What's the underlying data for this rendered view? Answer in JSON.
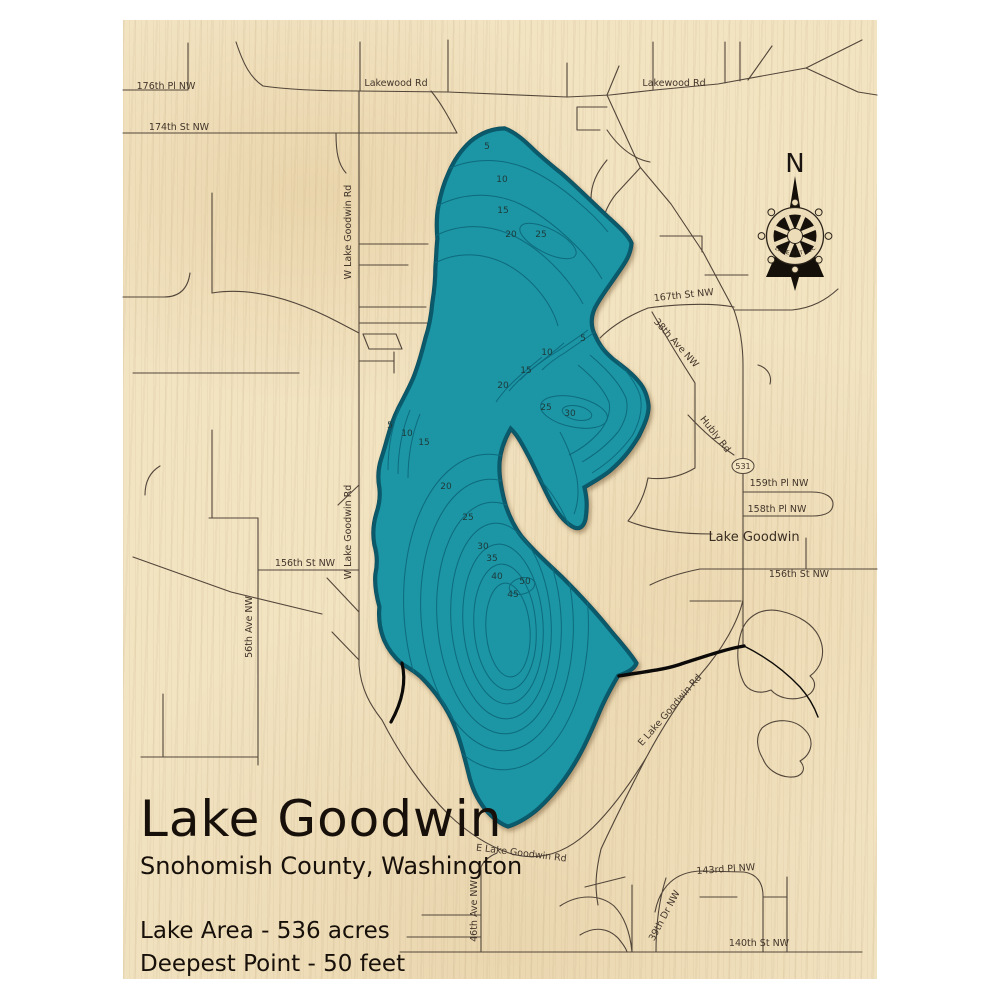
{
  "map": {
    "title": "Lake Goodwin",
    "subtitle": "Snohomish County, Washington",
    "stat_area": "Lake Area - 536 acres",
    "stat_depth": "Deepest Point - 50 feet",
    "route_marker": "531",
    "compass": {
      "north_label": "N",
      "brand": "LAKE ART LLC"
    },
    "colors": {
      "wood": "#f2e3c1",
      "lake_fill": "#1e95a4",
      "lake_edge": "#0a5a6b",
      "contour": "#0d6b7d",
      "road": "#52463a",
      "ink": "#17100a"
    },
    "place_labels": [
      {
        "text": "Lake Goodwin",
        "x": 754,
        "y": 541,
        "rot": 0
      }
    ],
    "road_labels": [
      {
        "text": "176th Pl NW",
        "x": 166,
        "y": 89,
        "rot": 0
      },
      {
        "text": "174th St NW",
        "x": 179,
        "y": 130,
        "rot": 0
      },
      {
        "text": "Lakewood Rd",
        "x": 396,
        "y": 86,
        "rot": 0
      },
      {
        "text": "Lakewood Rd",
        "x": 674,
        "y": 86,
        "rot": 0
      },
      {
        "text": "W Lake Goodwin Rd",
        "x": 351,
        "y": 232,
        "rot": -90
      },
      {
        "text": "W Lake Goodwin Rd",
        "x": 351,
        "y": 532,
        "rot": -90
      },
      {
        "text": "167th St NW",
        "x": 684,
        "y": 298,
        "rot": -6
      },
      {
        "text": "38th Ave NW",
        "x": 674,
        "y": 345,
        "rot": 48
      },
      {
        "text": "Hubly Rd",
        "x": 713,
        "y": 436,
        "rot": 52
      },
      {
        "text": "159th Pl NW",
        "x": 779,
        "y": 486,
        "rot": 0
      },
      {
        "text": "158th Pl NW",
        "x": 777,
        "y": 512,
        "rot": 0
      },
      {
        "text": "156th St NW",
        "x": 799,
        "y": 577,
        "rot": 0
      },
      {
        "text": "156th St NW",
        "x": 305,
        "y": 566,
        "rot": 0
      },
      {
        "text": "56th Ave NW",
        "x": 252,
        "y": 627,
        "rot": -90
      },
      {
        "text": "E Lake Goodwin Rd",
        "x": 672,
        "y": 712,
        "rot": -49
      },
      {
        "text": "E Lake Goodwin Rd",
        "x": 521,
        "y": 856,
        "rot": 7
      },
      {
        "text": "46th Ave NW",
        "x": 477,
        "y": 911,
        "rot": -90
      },
      {
        "text": "39th Dr NW",
        "x": 667,
        "y": 917,
        "rot": -62
      },
      {
        "text": "143rd Pl NW",
        "x": 726,
        "y": 872,
        "rot": -4
      },
      {
        "text": "140th St NW",
        "x": 759,
        "y": 946,
        "rot": 0
      }
    ],
    "depth_labels": [
      {
        "v": "5",
        "x": 487,
        "y": 149
      },
      {
        "v": "10",
        "x": 502,
        "y": 182
      },
      {
        "v": "15",
        "x": 503,
        "y": 213
      },
      {
        "v": "20",
        "x": 511,
        "y": 237
      },
      {
        "v": "25",
        "x": 541,
        "y": 237
      },
      {
        "v": "5",
        "x": 583,
        "y": 341
      },
      {
        "v": "10",
        "x": 547,
        "y": 355
      },
      {
        "v": "15",
        "x": 526,
        "y": 373
      },
      {
        "v": "20",
        "x": 503,
        "y": 388
      },
      {
        "v": "25",
        "x": 546,
        "y": 410
      },
      {
        "v": "30",
        "x": 570,
        "y": 416
      },
      {
        "v": "5",
        "x": 390,
        "y": 428
      },
      {
        "v": "10",
        "x": 407,
        "y": 436
      },
      {
        "v": "15",
        "x": 424,
        "y": 445
      },
      {
        "v": "20",
        "x": 446,
        "y": 489
      },
      {
        "v": "25",
        "x": 468,
        "y": 520
      },
      {
        "v": "30",
        "x": 483,
        "y": 549
      },
      {
        "v": "35",
        "x": 492,
        "y": 561
      },
      {
        "v": "40",
        "x": 497,
        "y": 579
      },
      {
        "v": "50",
        "x": 525,
        "y": 584
      },
      {
        "v": "45",
        "x": 513,
        "y": 597
      }
    ]
  }
}
